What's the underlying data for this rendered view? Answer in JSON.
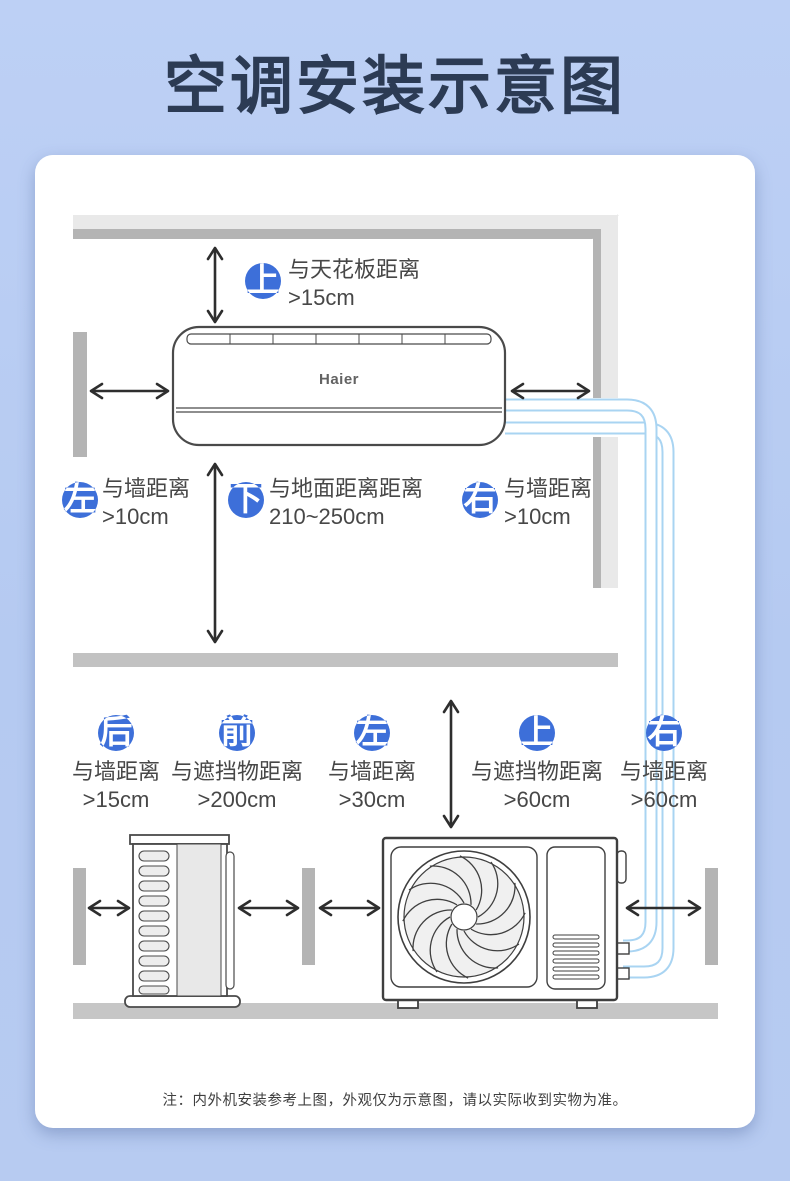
{
  "page": {
    "title": "空调安装示意图",
    "note": "注：内外机安装参考上图，外观仅为示意图，请以实际收到实物为准。"
  },
  "indoor_unit": {
    "brand": "Haier",
    "clearances": {
      "top": {
        "dir": "上",
        "label": "与天花板距离",
        "value": ">15cm"
      },
      "left": {
        "dir": "左",
        "label": "与墙距离",
        "value": ">10cm"
      },
      "bottom": {
        "dir": "下",
        "label": "与地面距离距离",
        "value": "210~250cm"
      },
      "right": {
        "dir": "右",
        "label": "与墙距离",
        "value": ">10cm"
      }
    }
  },
  "outdoor_unit": {
    "clearances": {
      "back": {
        "dir": "后",
        "label": "与墙距离",
        "value": ">15cm"
      },
      "front": {
        "dir": "前",
        "label": "与遮挡物距离",
        "value": ">200cm"
      },
      "left": {
        "dir": "左",
        "label": "与墙距离",
        "value": ">30cm"
      },
      "top": {
        "dir": "上",
        "label": "与遮挡物距离",
        "value": ">60cm"
      },
      "right": {
        "dir": "右",
        "label": "与墙距离",
        "value": ">60cm"
      }
    }
  },
  "colors": {
    "accent_blue": "#3d6fd9",
    "pipe_blue": "#a9d4f2",
    "title_navy": "#2c3b54",
    "wall_gray": "#b5b5b5",
    "ground_gray": "#c6c6c6",
    "background_blue": "#b7cbf1"
  }
}
